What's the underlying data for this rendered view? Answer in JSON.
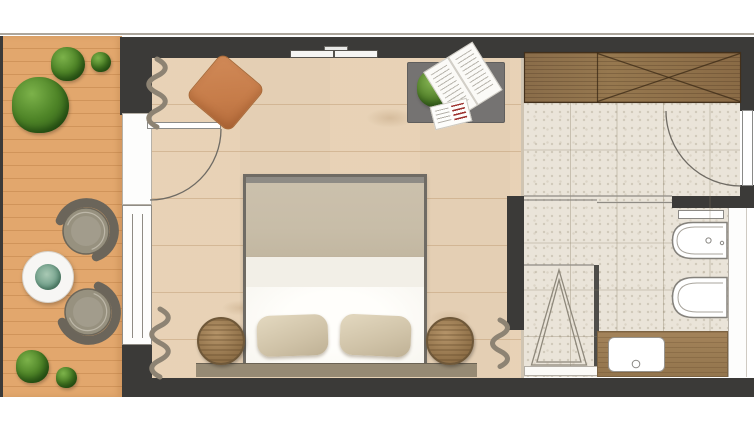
{
  "plan": {
    "kind": "architectural-floor-plan",
    "view": "top-down",
    "width_px": 754,
    "height_px": 435
  },
  "colors": {
    "wall": "#3b3a38",
    "terraceWood": "#dfa468",
    "terracePlank": "#cd9156",
    "bedroomFloor": "#ecd9c0",
    "tile": "#eae4d9",
    "wardrobeWood": "#8f7350",
    "vanityWood": "#9c7d54",
    "desk": "#757372",
    "pouf": "#ca8251",
    "duvet": "#c8bda8",
    "sheet": "#f2efe7",
    "mattress": "#fcfbf7",
    "pillow": "#d3c6ab",
    "headboard": "#968a74",
    "nightstand": "#a5875e",
    "nightstandEdge": "#6f5839",
    "curtain": "#8d8373",
    "glassPartition": "#4e4d49",
    "fixtureStroke": "#85827c",
    "chairSeat": "#97917f",
    "chairBack": "#6b655a",
    "tableTop": "#f7f6f4",
    "plantGreen": "#4e8427",
    "succulent": "#74a18c"
  },
  "rooms": [
    {
      "name": "terrace",
      "floor": "wood-decking",
      "items": [
        "large-potted-plant",
        "medium-potted-plant",
        "small-potted-plant",
        "round-coffee-table",
        "succulent-centerpiece",
        "lounge-chair-upper",
        "lounge-chair-lower",
        "potted-plant-bottom-large",
        "potted-plant-bottom-small"
      ]
    },
    {
      "name": "bedroom",
      "floor": "light-pine-plank",
      "items": [
        "terrace-door",
        "window",
        "curtain-top",
        "curtain-bottom-left",
        "curtain-bottom-right",
        "orange-ottoman",
        "wall-mounted-tv",
        "side-table-with-plant-and-magazines",
        "double-bed",
        "pillow-left",
        "pillow-right",
        "headboard-panel",
        "wicker-nightstand-left",
        "wicker-nightstand-right"
      ]
    },
    {
      "name": "bathroom",
      "floor": "terrazzo-tile",
      "items": [
        "wardrobe-with-cross-symbol",
        "entrance-door",
        "glass-partition",
        "shower-with-slope-triangle",
        "shower-screen",
        "shelf",
        "bidet",
        "toilet",
        "vanity-counter",
        "washbasin"
      ]
    }
  ]
}
